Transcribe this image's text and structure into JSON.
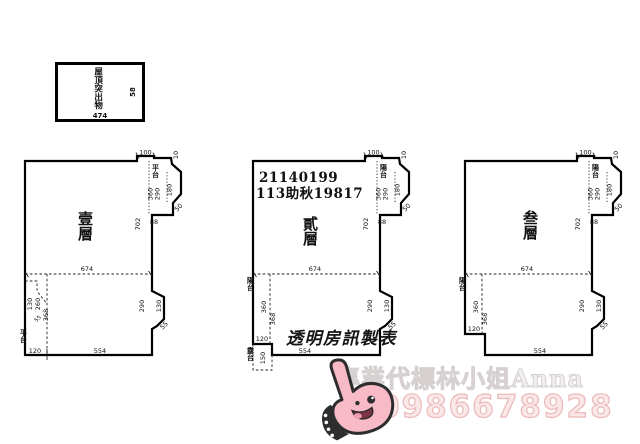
{
  "roof_box": {
    "label": "屋頂突出物",
    "width": "474",
    "height": "58"
  },
  "plans": [
    {
      "floor": "壹層",
      "balcony": "平台",
      "platform": "平台",
      "dims": {
        "top": "100",
        "step": "10",
        "b1": "360",
        "b2": "290",
        "b3": "180",
        "wall": "702",
        "bw": "88",
        "chamfer": "50",
        "mid": "674",
        "na": "290",
        "nb": "130",
        "nc": "55",
        "bottom": "554",
        "corner": "120",
        "p1": "130",
        "p2": "260",
        "p3": "55",
        "p4": "368"
      }
    },
    {
      "floor": "貳層",
      "header1": "21140199",
      "header2": "113助秋19817",
      "balcony": "陽台",
      "platform": "陽台",
      "terrace": "露台",
      "dims": {
        "top": "100",
        "step": "10",
        "b1": "360",
        "b2": "290",
        "b3": "180",
        "wall": "702",
        "bw": "88",
        "chamfer": "50",
        "mid": "674",
        "na": "290",
        "nb": "130",
        "nc": "55",
        "bottom": "554",
        "corner": "120",
        "p1": "360",
        "p2": "368",
        "terrace_h": "150"
      }
    },
    {
      "floor": "叁層",
      "balcony": "陽台",
      "platform": "陽台",
      "dims": {
        "top": "100",
        "step": "10",
        "b1": "360",
        "b2": "290",
        "b3": "180",
        "wall": "702",
        "bw": "88",
        "chamfer": "50",
        "mid": "674",
        "na": "290",
        "nb": "130",
        "nc": "55",
        "bottom": "554",
        "corner": "120",
        "p1": "360",
        "p2": "368"
      }
    }
  ],
  "watermarks": {
    "maker": "透明房訊製表",
    "agent": "專業代標林小姐Anna",
    "phone": "0986678928"
  },
  "colors": {
    "line_black": "#111111",
    "phone_pink": "#eab8b8",
    "agent_gray": "#d7d0d0",
    "sticker_pink": "#f7bac6"
  },
  "icons": {
    "thumbs_up_sticker": "pink thumbs-up hand with cute face"
  }
}
